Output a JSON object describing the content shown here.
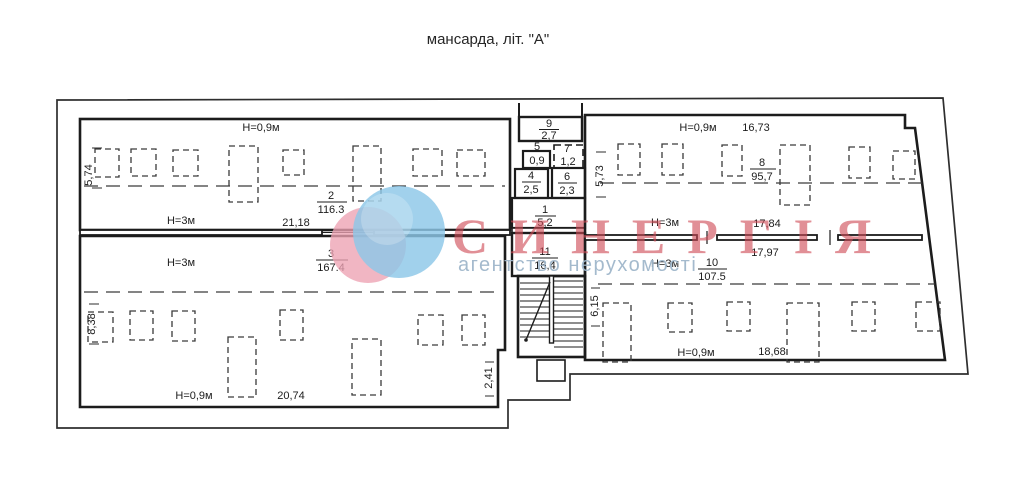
{
  "title": "мансарда, літ. \"А\"",
  "watermark": {
    "brand": "СИНЕРГІЯ",
    "tagline": "агентство нерухомості"
  },
  "heights": {
    "low": "Н=0,9м",
    "high": "Н=3м"
  },
  "rooms": {
    "r1": {
      "num": "1",
      "area": "5,2"
    },
    "r2": {
      "num": "2",
      "area": "116.3"
    },
    "r3": {
      "num": "3",
      "area": "167.4"
    },
    "r4": {
      "num": "4",
      "area": "2,5"
    },
    "r5": {
      "num": "5",
      "area": "0,9"
    },
    "r6": {
      "num": "6",
      "area": "2,3"
    },
    "r7": {
      "num": "7",
      "area": "1,2"
    },
    "r8": {
      "num": "8",
      "area": "95,7"
    },
    "r9": {
      "num": "9",
      "area": "2,7"
    },
    "r10": {
      "num": "10",
      "area": "107.5"
    },
    "r11": {
      "num": "11",
      "area": "16,4"
    }
  },
  "dims": {
    "left_top_v": "5,74",
    "left_bottom_v": "8,38",
    "mid_top_h": "21,18",
    "bottom_h": "20,74",
    "center_v": "5,73",
    "right_v": "6,15",
    "step_v": "2,41",
    "right_top_h": "16,73",
    "right_wall_above": "17,84",
    "right_wall_below": "17,97",
    "right_bottom_h": "18,68"
  },
  "colors": {
    "wall": "#1c1c1c",
    "brand_red": "#cf4a55",
    "logo_blue": "#8cc7e8",
    "logo_pink": "#eda2b2",
    "tagline_gray": "#9fb6ca"
  }
}
